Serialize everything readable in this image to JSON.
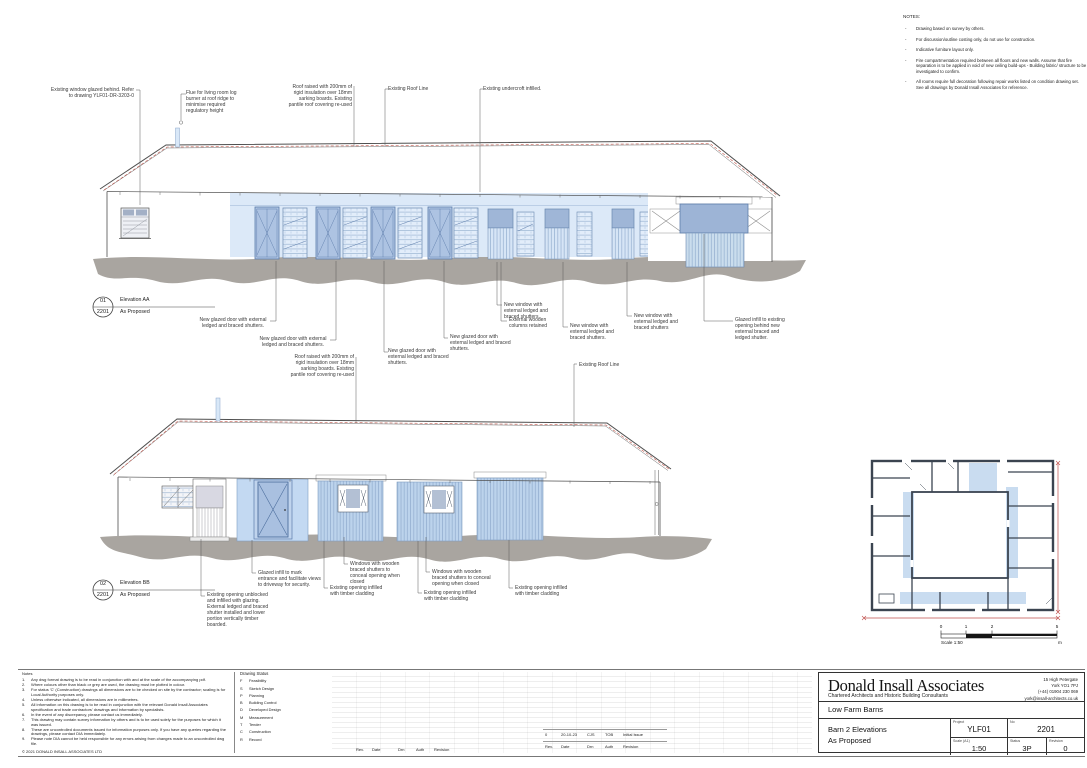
{
  "notes_panel": {
    "title": "NOTES:",
    "items": [
      "Drawing based on survey by others.",
      "For discussion/outline costing only, do not use for construction.",
      "Indicative furniture layout only.",
      "Fire compartmentation required between all floors and new walls. Assume that fire separation is to be applied in void of new ceiling build-ups - Building fabric/ structure to be investigated to confirm.",
      "All rooms require full decoration following repair works listed on condition drawing set. See all drawings by Donald Insall Associates for reference."
    ]
  },
  "annotations": {
    "top": [
      "Existing window glazed behind. Refer to drawing YLF01-DR-3203-0",
      "Flue for living room log burner at roof ridge to minimise required regulatory height",
      "Roof raised with 200mm of rigid insulation over 18mm sarking boards. Existing pantile roof covering re-used",
      "Existing Roof Line",
      "Existing undercroft infilled."
    ],
    "aa": [
      "New glazed door with external ledged and braced shutters.",
      "New glazed door with external ledged and braced shutters.",
      "New glazed door with external ledged and braced shutters.",
      "New glazed door with external ledged and braced shutters.",
      "New window with external ledged and braced shutters.",
      "External wooden columns retained",
      "New window with external ledged and braced shutters.",
      "New window with external ledged and braced shutters",
      "Glazed infill to existing opening behind new external braced and ledged shutter."
    ],
    "bb_top": [
      "Roof raised with 200mm of rigid insulation over 18mm sarking boards. Existing pantile roof covering re-used",
      "Existing Roof Line"
    ],
    "bb": [
      "Glazed infill to mark entrance and facilitate views to driveway for security.",
      "Windows with wooden braced shutters to conceal opening when closed",
      "Windows with wooden braced shutters to conceal opening when closed",
      "Existing opening infilled with timber cladding",
      "Existing opening infilled with timber cladding",
      "Existing opening infilled with timber cladding",
      "Existing opening unblocked and infilled with glazing. External ledged and braced shutter installed and lower portion vertically timber boarded."
    ]
  },
  "markers": {
    "aa": {
      "num": "01",
      "sheet": "2201",
      "title": "Elevation AA",
      "subtitle": "As Proposed"
    },
    "bb": {
      "num": "02",
      "sheet": "2201",
      "title": "Elevation BB",
      "subtitle": "As Proposed"
    }
  },
  "scale_bar": {
    "ticks": [
      "0",
      "1",
      "2",
      "5"
    ],
    "label": "Scale 1:50",
    "unit": "m"
  },
  "footer": {
    "notes": {
      "title": "Notes",
      "items": [
        "Any dwg format drawing is to be read in conjunction with and at the scale of the accompanying pdf.",
        "Where colours other than black or grey are used, the drawing must be plotted in colour.",
        "For status 'C' (Construction) drawings all dimensions are to be checked on site by the contractor; scaling is for Local Authority purposes only.",
        "Unless otherwise indicated, all dimensions are in millimetres.",
        "All information on this drawing is to be read in conjunction with the relevant Donald Insall Associates specification and trade contractors' drawings and information by specialists.",
        "In the event of any discrepancy, please contact us immediately.",
        "This drawing may contain survey information by others and is to be used solely for the purposes for which it was issued.",
        "These are uncontrolled documents issued for information purposes only. If you have any queries regarding the drawings, please contact DIA immediately.",
        "Please note DIA cannot be held responsible for any errors arising from changes made to an uncontrolled dwg file."
      ],
      "copyright": "© 2021 DONALD INSALL ASSOCIATES LTD"
    },
    "drawing_status": {
      "title": "Drawing Status",
      "items": [
        {
          "code": "F",
          "label": "Feasibility"
        },
        {
          "code": "S",
          "label": "Sketch Design"
        },
        {
          "code": "P",
          "label": "Planning"
        },
        {
          "code": "B",
          "label": "Building Control"
        },
        {
          "code": "D",
          "label": "Developed Design"
        },
        {
          "code": "M",
          "label": "Measurement"
        },
        {
          "code": "T",
          "label": "Tender"
        },
        {
          "code": "C",
          "label": "Construction"
        },
        {
          "code": "R",
          "label": "Record"
        }
      ]
    },
    "revision_table": {
      "headers": [
        "Rev.",
        "Date",
        "Drn",
        "Auth",
        "Revision"
      ],
      "entry": [
        "0",
        "20-10-23",
        "CJS",
        "TOB",
        "Initial Issue"
      ]
    },
    "title_block": {
      "firm": "Donald Insall Associates",
      "firm_subtitle": "Chartered Architects and Historic Building Consultants",
      "address": [
        "15 High Petergate",
        "York YO1 7PJ",
        "(+44) 01904 230 069",
        "york@insall-architects.co.uk"
      ],
      "project_name": "Low Farm Barns",
      "drawing_title": [
        "Barn 2 Elevations",
        "As Proposed"
      ],
      "labels": {
        "project": "Project",
        "no": "No",
        "scale": "Scale (A1)",
        "status": "Status",
        "revision": "Revision"
      },
      "values": {
        "project": "YLF01",
        "no": "2201",
        "scale": "1:50",
        "status": "3P",
        "revision": "0"
      }
    }
  },
  "colors": {
    "wall_tint_blue": "#dce9f8",
    "glazing_blue": "#9fb6d7",
    "door_blue": "#adc3e2",
    "ground_grey": "#a9a5a0",
    "roofline_red": "#c4554a",
    "plan_wall": "#3b4450",
    "plan_highlight": "#c9dcf0",
    "section_red": "#c0504d"
  }
}
